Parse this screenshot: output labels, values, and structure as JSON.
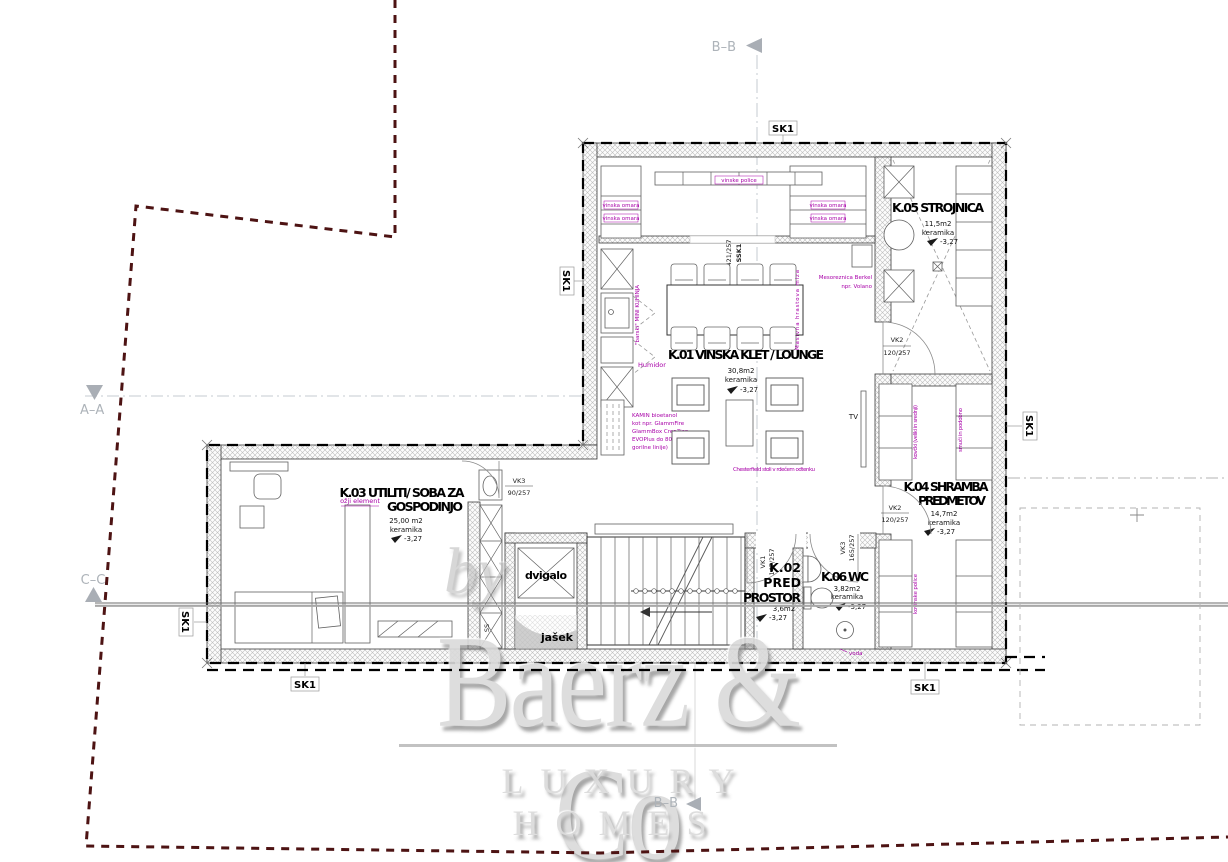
{
  "sections": {
    "top": "B–B",
    "bottom": "B–B",
    "a": "A–A",
    "c": "C–C"
  },
  "tag": "SK1",
  "rooms": {
    "k01": {
      "title": "K.01 VINSKA KLET / LOUNGE",
      "area": "30,8m2",
      "finish": "keramika",
      "level": "-3,27"
    },
    "k02": {
      "l1": "K.02",
      "l2": "PRED",
      "l3": "PROSTOR",
      "area": "3,6m2",
      "level": "-3,27"
    },
    "k03": {
      "l1": "K.03 UTILITI/ SOBA ZA",
      "l2": "GOSPODINJO",
      "area": "25,00 m2",
      "finish": "keramika",
      "level": "-3,27"
    },
    "k04": {
      "l1": "K.04 SHRAMBA",
      "l2": "PREDMETOV",
      "area": "14,7m2",
      "finish": "keramika",
      "level": "-3,27"
    },
    "k05": {
      "title": "K.05 STROJNICA",
      "area": "11,5m2",
      "finish": "keramika",
      "level": "-3,27"
    },
    "k06": {
      "title": "K.06 WC",
      "area": "3,82m2",
      "finish": "keramika",
      "level": "-3,27"
    }
  },
  "core": {
    "elevator": "dvigalo",
    "shaft": "jašek",
    "ss": "SS",
    "stairs_level": "-3,27"
  },
  "doors": {
    "vk3a": {
      "code": "VK3",
      "size": "90/257"
    },
    "vk1": {
      "code": "VK1",
      "size": "147/257"
    },
    "vk3b": {
      "code": "VK3",
      "size": "165/257"
    },
    "vk2a": {
      "code": "VK2",
      "size": "120/257"
    },
    "vk2b": {
      "code": "VK2",
      "size": "120/257"
    },
    "ssk1": {
      "code": "SSK1",
      "size": "421/257"
    }
  },
  "notes": {
    "wine": "vinska omara",
    "shelf_top": "vinske police",
    "minikitchen": "\"barski\" MINI KUHINJA",
    "humidor": "Humidor",
    "slicer1": "Mesoreznica Berkel",
    "slicer2": "npr. Volano",
    "kamin": [
      "KAMIN bioetanol",
      "kot npr. GlammFire",
      "GlammBox Crea7ion",
      "EVOPlus do 80cm",
      "gorilne linije)"
    ],
    "chesterfield": "Chesterfield stoli v rdečem odtenku",
    "table": "Masivna hrastova miza",
    "tv": "TV",
    "narrow": "ožji element",
    "luggage": "kovčki (veliki in srednji)",
    "ski": "smuči in podobno",
    "metal": "kovinske police",
    "water": "voda"
  },
  "watermark": {
    "by": "by",
    "brand": "Baerz & Co",
    "tagline": "LUXURY HOMES"
  }
}
